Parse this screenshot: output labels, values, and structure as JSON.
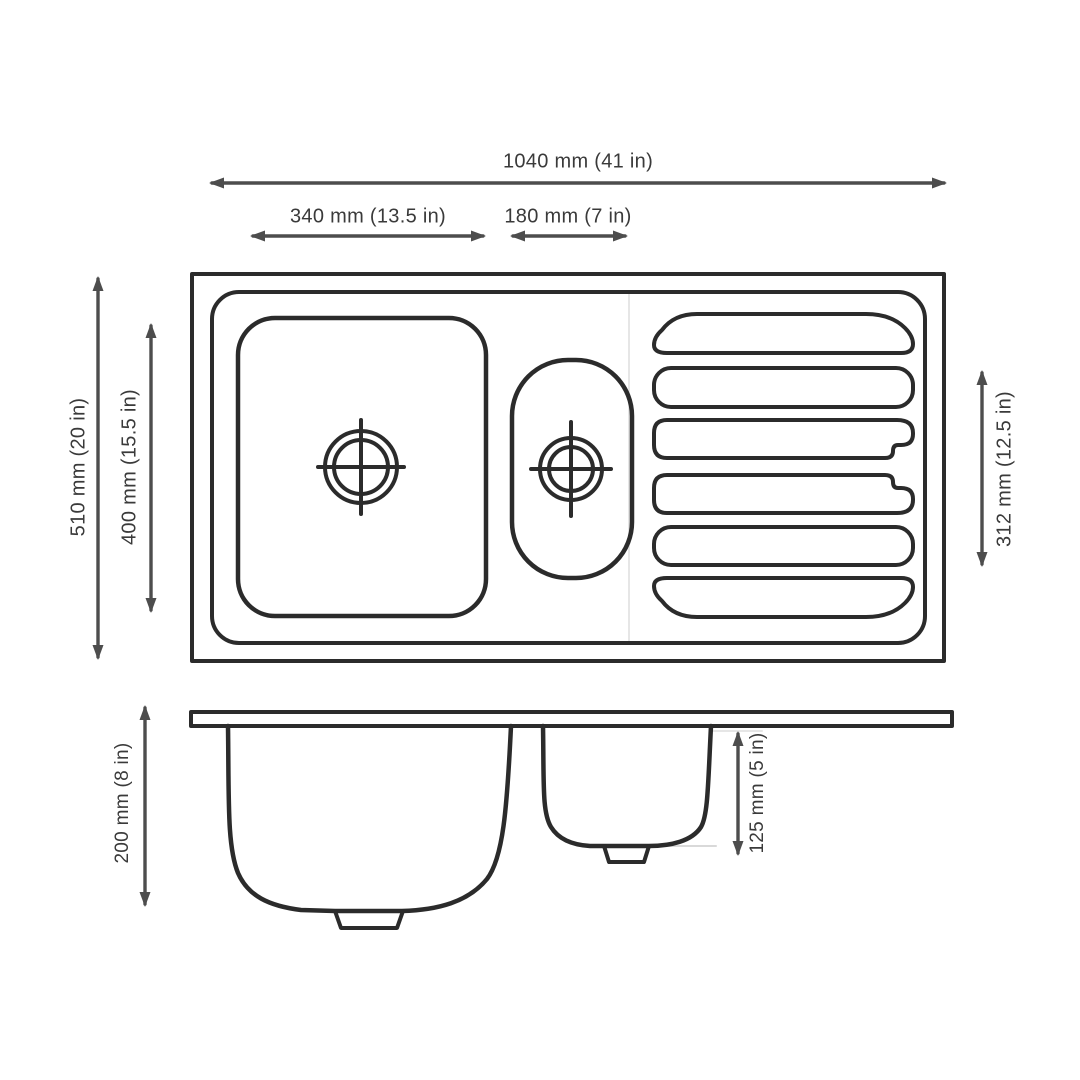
{
  "diagram": {
    "type": "technical-drawing",
    "subject": "Kitchen sink with main bowl, half bowl and ribbed drainboard, top view and side profile view",
    "background_color": "#ffffff",
    "line_color": "#2b2b2b",
    "arrow_color": "#4d4d4d",
    "text_color": "#3a3a3a",
    "faint_line_color": "#d9d9d9"
  },
  "measurements": [
    {
      "id": "overall-width",
      "view": "top",
      "mm": 1040,
      "inches": 41,
      "label": "1040 mm (41 in)"
    },
    {
      "id": "main-bowl-width",
      "view": "top",
      "mm": 340,
      "inches": 13.5,
      "label": "340 mm (13.5 in)"
    },
    {
      "id": "half-bowl-width",
      "view": "top",
      "mm": 180,
      "inches": 7,
      "label": "180 mm (7 in)"
    },
    {
      "id": "overall-depth",
      "view": "top",
      "mm": 510,
      "inches": 20,
      "label": "510 mm (20 in)"
    },
    {
      "id": "main-bowl-depth",
      "view": "top",
      "mm": 400,
      "inches": 15.5,
      "label": "400 mm (15.5 in)"
    },
    {
      "id": "drainboard-length",
      "view": "top",
      "mm": 312,
      "inches": 12.5,
      "label": "312 mm (12.5 in)"
    },
    {
      "id": "main-bowl-height",
      "view": "side",
      "mm": 200,
      "inches": 8,
      "label": "200 mm (8 in)"
    },
    {
      "id": "half-bowl-height",
      "view": "side",
      "mm": 125,
      "inches": 5,
      "label": "125 mm (5 in)"
    }
  ]
}
